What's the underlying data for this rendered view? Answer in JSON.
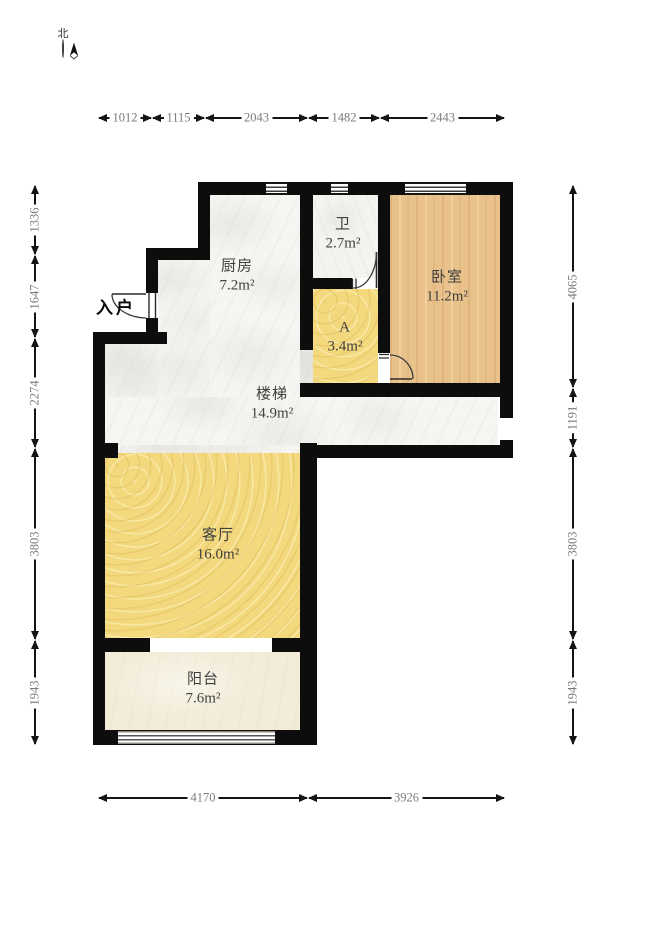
{
  "compass": {
    "north_label": "北"
  },
  "entrance": {
    "label": "入户"
  },
  "rooms": {
    "kitchen": {
      "name": "厨房",
      "area": "7.2m²"
    },
    "bath": {
      "name": "卫",
      "area": "2.7m²"
    },
    "bedroom": {
      "name": "卧室",
      "area": "11.2m²"
    },
    "room_a": {
      "name": "A",
      "area": "3.4m²"
    },
    "stairs": {
      "name": "楼梯",
      "area": "14.9m²"
    },
    "living": {
      "name": "客厅",
      "area": "16.0m²"
    },
    "balcony": {
      "name": "阳台",
      "area": "7.6m²"
    }
  },
  "dimensions": {
    "top": [
      "1012",
      "1115",
      "2043",
      "1482",
      "2443"
    ],
    "bottom": [
      "4170",
      "3926"
    ],
    "left": [
      "1336",
      "1647",
      "2274",
      "3803",
      "1943"
    ],
    "right": [
      "4065",
      "1191",
      "3803",
      "1943"
    ]
  },
  "colors": {
    "wall": "#0d0d0d",
    "marble_floor": "#f6f5f1",
    "yellow_floor": "#f3d87d",
    "wood_floor": "#e9c28b",
    "cream_floor": "#f2ecd8",
    "dimension_text": "#7b7b7b",
    "room_text": "#3f3f3f"
  }
}
